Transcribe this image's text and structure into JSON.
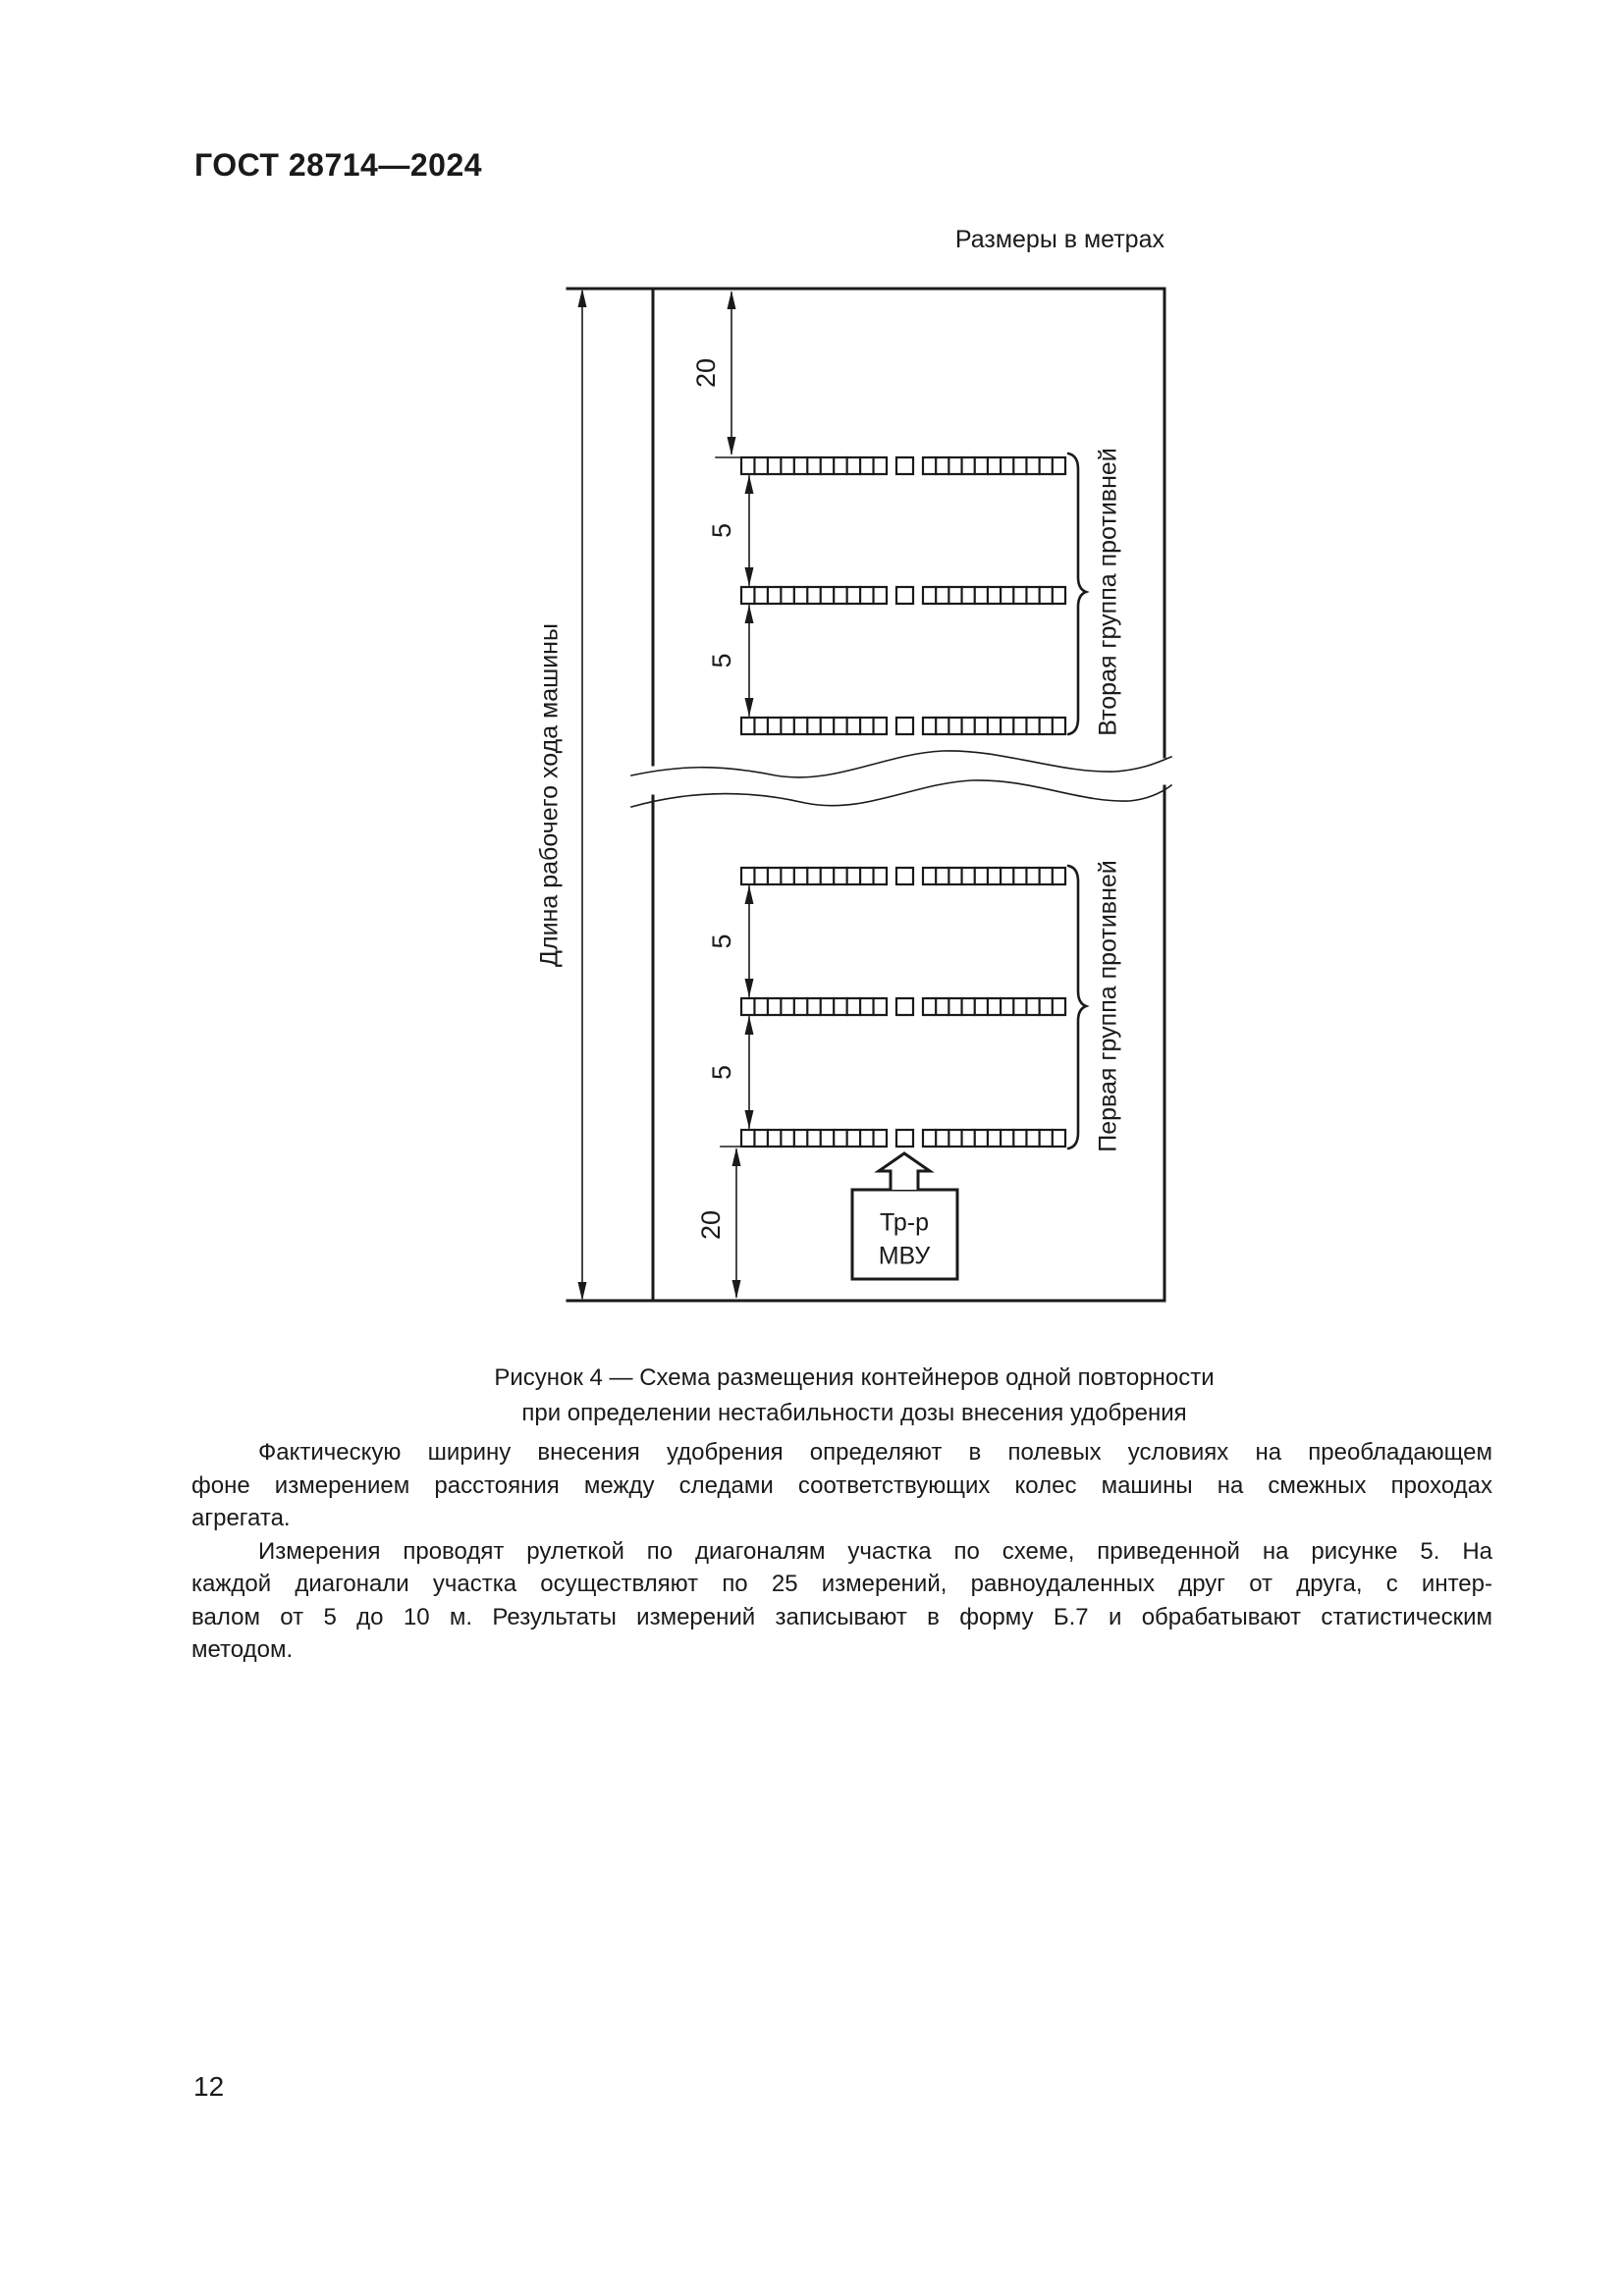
{
  "page": {
    "header": "ГОСТ 28714—2024",
    "page_number": "12"
  },
  "figure": {
    "units_note": "Размеры в метрах",
    "left_axis_label": "Длина рабочего хода машины",
    "group_top_label": "Вторая группа противней",
    "group_bottom_label": "Первая группа противней",
    "tractor_line1": "Тр-р",
    "tractor_line2": "МВУ",
    "dims": {
      "top_gap": "20",
      "row_gap": "5",
      "bottom_gap": "20"
    },
    "caption_line1": "Рисунок 4 — Схема размещения контейнеров одной повторности",
    "caption_line2": "при определении нестабильности дозы внесения удобрения"
  },
  "paragraphs": [
    {
      "lines": [
        "Фактическую ширину внесения удобрения определяют в полевых условиях на преобладающем",
        "фоне измерением расстояния между следами соответствующих колес машины на смежных проходах",
        "агрегата."
      ]
    },
    {
      "lines": [
        "Измерения проводят рулеткой по диагоналям участка по схеме, приведенной на рисунке 5. На",
        "каждой диагонали участка осуществляют по 25 измерений, равноудаленных друг от друга, с интер-",
        "валом от 5 до 10 м. Результаты измерений записывают в форму Б.7 и обрабатывают статистическим",
        "методом."
      ]
    }
  ]
}
